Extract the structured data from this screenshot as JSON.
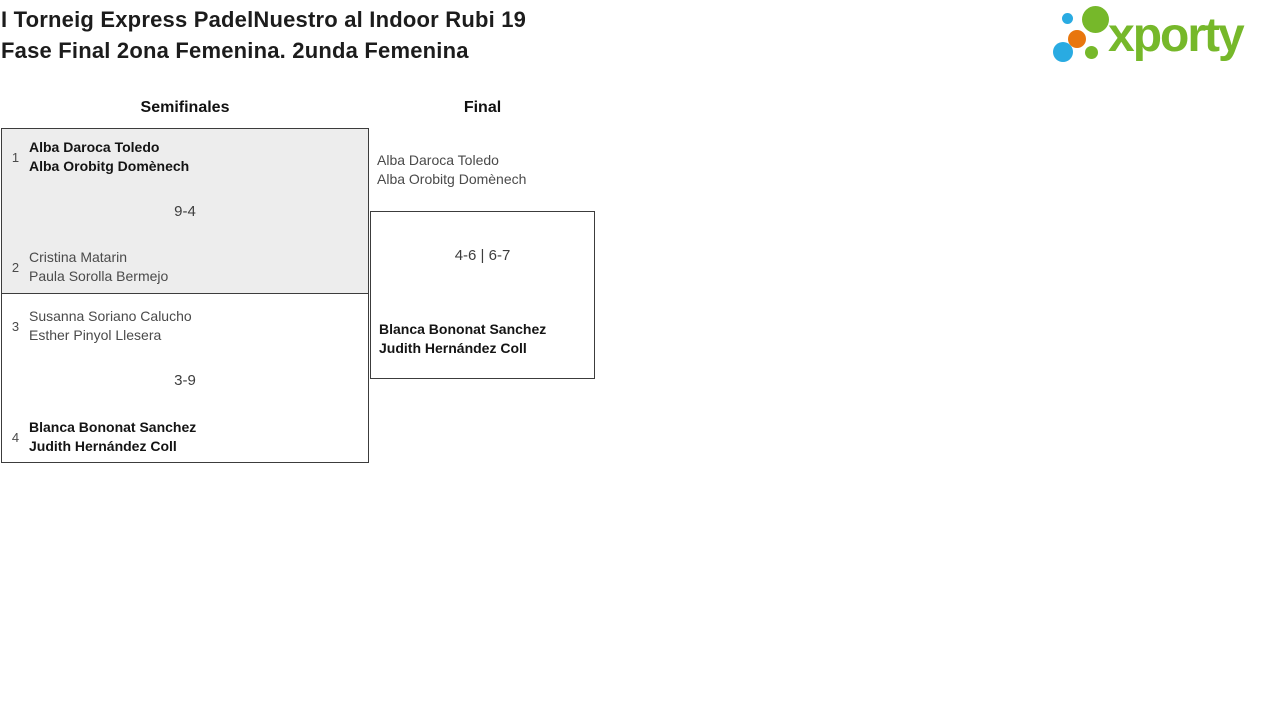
{
  "page": {
    "title_line1": "I Torneig Express PadelNuestro al Indoor Rubi 19",
    "title_line2": "Fase Final 2ona Femenina. 2unda Femenina"
  },
  "logo": {
    "text": "xporty",
    "colors": {
      "green": "#76b82a",
      "blue": "#29abe2",
      "orange": "#e8760d"
    }
  },
  "bracket": {
    "rounds": [
      {
        "label": "Semifinales"
      },
      {
        "label": "Final"
      }
    ],
    "semifinals": [
      {
        "score": "9-4",
        "teams": [
          {
            "seed": "1",
            "player1": "Alba Daroca Toledo",
            "player2": "Alba Orobitg Domènech",
            "winner": true
          },
          {
            "seed": "2",
            "player1": "Cristina Matarin",
            "player2": "Paula Sorolla Bermejo",
            "winner": false
          }
        ]
      },
      {
        "score": "3-9",
        "teams": [
          {
            "seed": "3",
            "player1": "Susanna Soriano Calucho",
            "player2": "Esther Pinyol Llesera",
            "winner": false
          },
          {
            "seed": "4",
            "player1": "Blanca Bononat Sanchez",
            "player2": "Judith Hernández Coll",
            "winner": true
          }
        ]
      }
    ],
    "final": {
      "score": "4-6 | 6-7",
      "teams": [
        {
          "player1": "Alba Daroca Toledo",
          "player2": "Alba Orobitg Domènech",
          "winner": false
        },
        {
          "player1": "Blanca Bononat Sanchez",
          "player2": "Judith Hernández Coll",
          "winner": true
        }
      ]
    }
  }
}
